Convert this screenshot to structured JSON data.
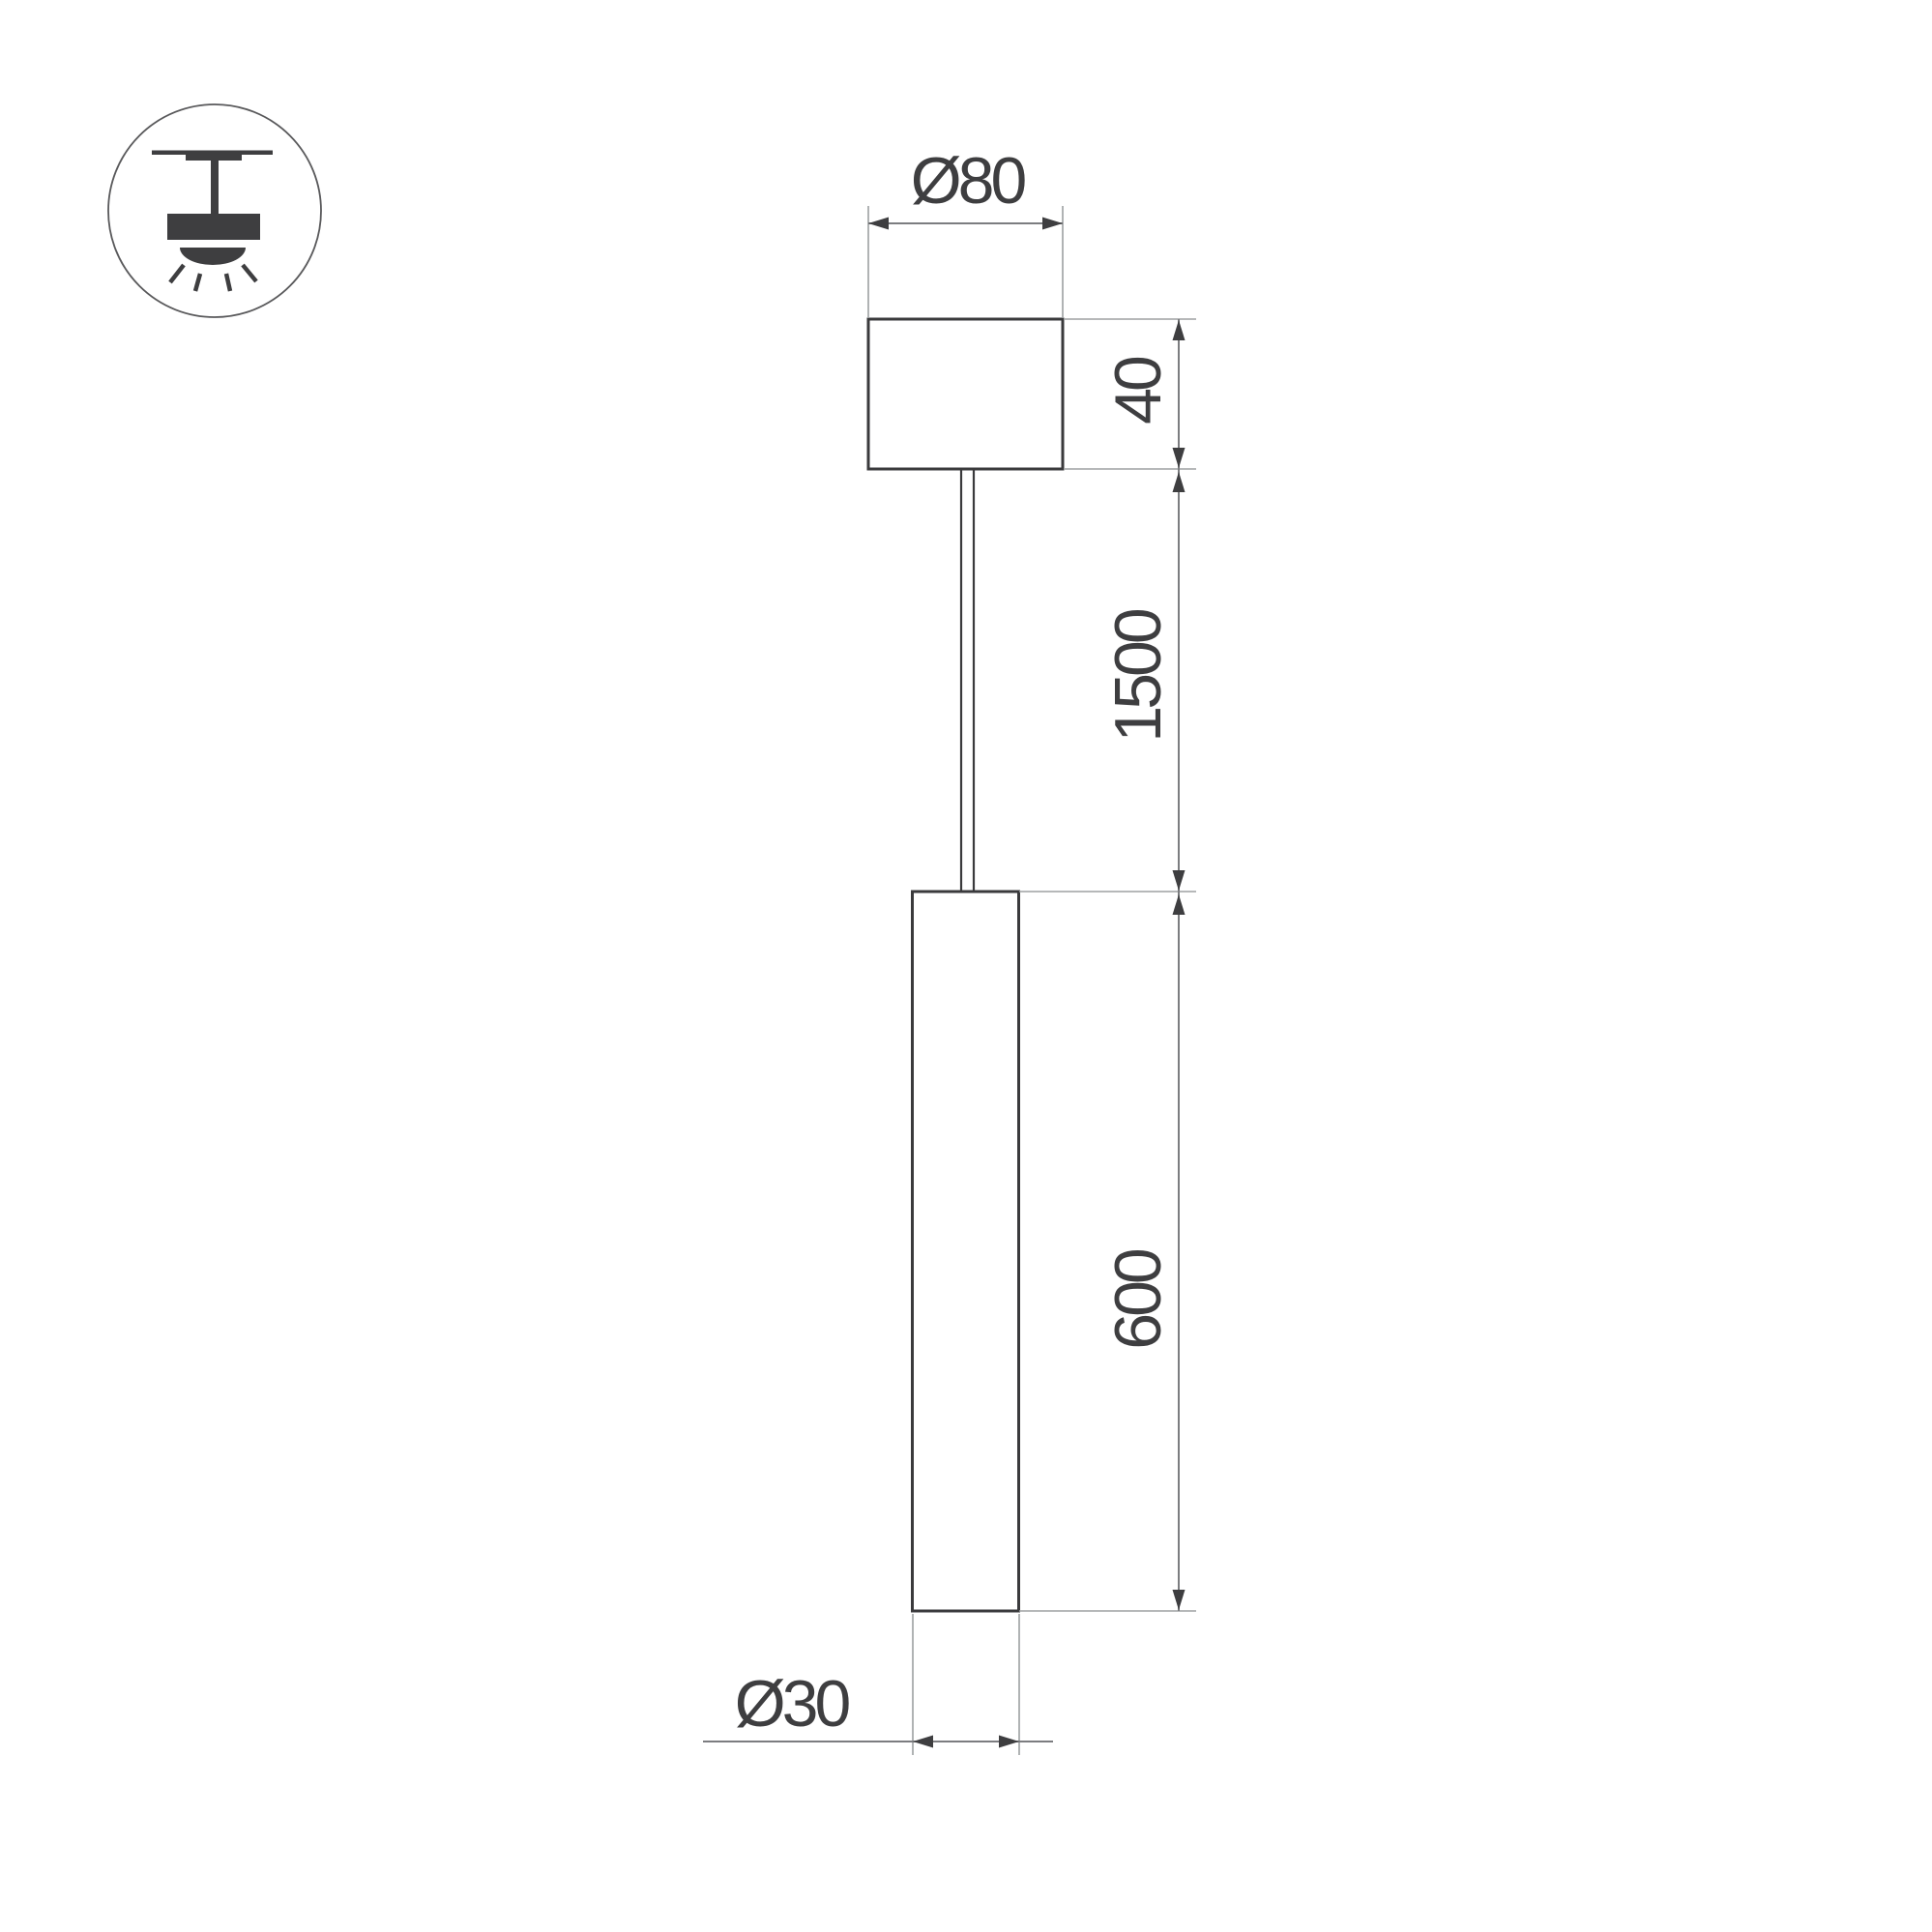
{
  "page": {
    "type": "technical-drawing",
    "subject": "pendant-tube-luminaire",
    "background": "#ffffff"
  },
  "colors": {
    "ink": "#3e3e40",
    "object_line": "#3a3a3c",
    "dimension_line": "#7c7d80",
    "extension_line": "#9da0a2",
    "icon_circle": "#59595b"
  },
  "icon": {
    "name": "pendant-ceiling-light-icon",
    "description": "circled glyph of a lamp hanging from ceiling with downward light rays"
  },
  "dimensions": {
    "canopy_diameter": {
      "label": "Ø80",
      "value": 80,
      "unit": "mm"
    },
    "canopy_height": {
      "label": "40",
      "value": 40,
      "unit": "mm"
    },
    "suspension_length": {
      "label": "1500",
      "value": 1500,
      "unit": "mm"
    },
    "tube_length": {
      "label": "600",
      "value": 600,
      "unit": "mm"
    },
    "tube_diameter": {
      "label": "Ø30",
      "value": 30,
      "unit": "mm"
    }
  }
}
